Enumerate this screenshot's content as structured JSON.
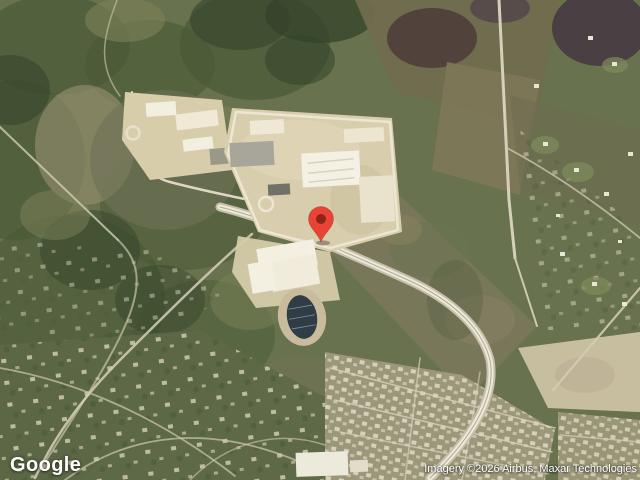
{
  "branding": {
    "logo_text": "Google"
  },
  "attribution": {
    "text": "Imagery ©2026 Airbus, Maxar Technologies"
  },
  "map": {
    "view": "satellite",
    "marker": {
      "fill": "#EA4335",
      "dot": "#8C2417"
    },
    "imagery_palette": {
      "forest": "#5f6b47",
      "forest_dark": "#41512f",
      "field": "#7a775a",
      "development_pad": "#d8cead",
      "building": "#f3efe2",
      "road": "#e7e1cf",
      "parking": "#a8a69a",
      "pond": "#4e3e3a",
      "track": "#303c46",
      "houses": "#d6cfb8"
    }
  }
}
